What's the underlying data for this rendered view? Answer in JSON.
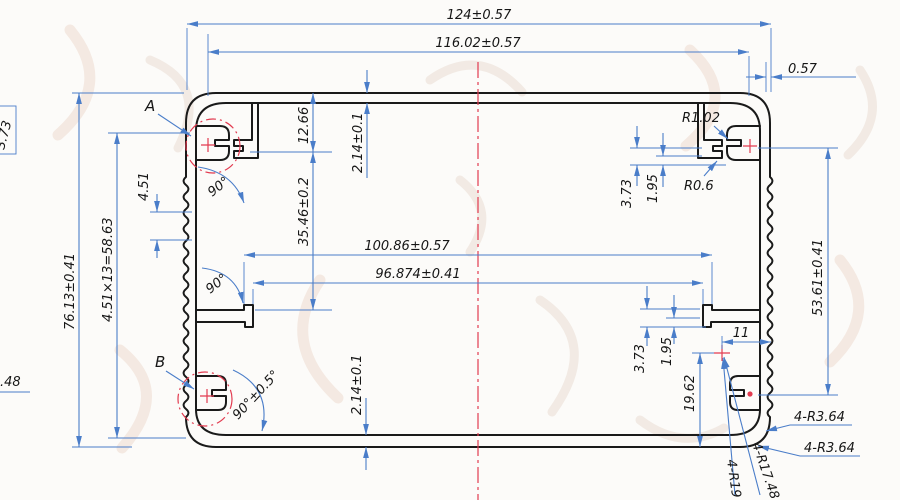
{
  "drawing_type": "aluminum-extrusion-enclosure-cross-section",
  "palette": {
    "profile_line": "#1a1a1a",
    "dimension_line": "#4a7dc9",
    "detail_marker": "#e23b50",
    "paper": "#fcfbf9",
    "watermark": "#f2e3da"
  },
  "labels": {
    "overall_width": "124±0.57",
    "inner_width": "116.02±0.57",
    "fin_offset": "0.57",
    "radius_top": "R1.02",
    "radius_slot": "R0.6",
    "slot_depth_top": "3.73",
    "slot_width_top": "1.95",
    "boss_center_drop": "12.66",
    "wall_top": "2.14±0.1",
    "cavity_upper": "35.46±0.2",
    "rail_span_outer": "100.86±0.57",
    "rail_span_inner": "96.874±0.41",
    "angle_top_left": "90°",
    "angle_mid_left": "90°",
    "fin_pitch": "4.51",
    "fin_total": "4.51×13=58.63",
    "overall_height": "76.13±0.41",
    "edge_boxed": "3.73",
    "detail_a": "A",
    "detail_b": "B",
    "angle_bottom_left": "90°±0.5°",
    "wall_bottom": "2.14±0.1",
    "edge_clipped": ".48",
    "screw_span_right": "53.61±0.41",
    "slot_depth_bottom": "3.73",
    "slot_width_bottom": "1.95",
    "boss_offset": "11",
    "boss_center_height": "19.62",
    "corner_radius_a": "4-R3.64",
    "corner_radius_b": "4-R3.64",
    "boss_radius_a": "4-R17.48",
    "boss_radius_b": "4-R19"
  }
}
